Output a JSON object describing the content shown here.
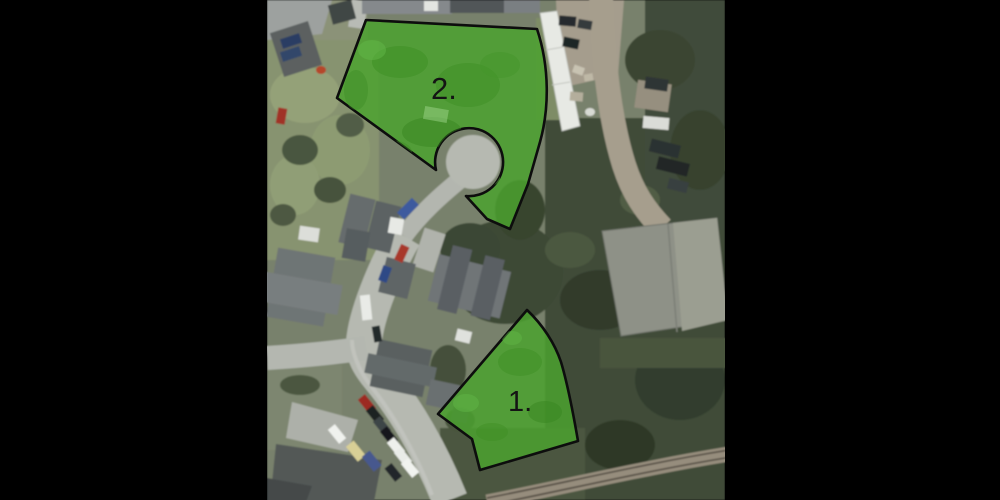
{
  "annotations": {
    "parcel_1": {
      "label": "1."
    },
    "parcel_2": {
      "label": "2."
    }
  },
  "colors": {
    "overlay_green": "#4ba22e",
    "overlay_outline": "#0d0d0d",
    "letterbox": "#000000"
  }
}
